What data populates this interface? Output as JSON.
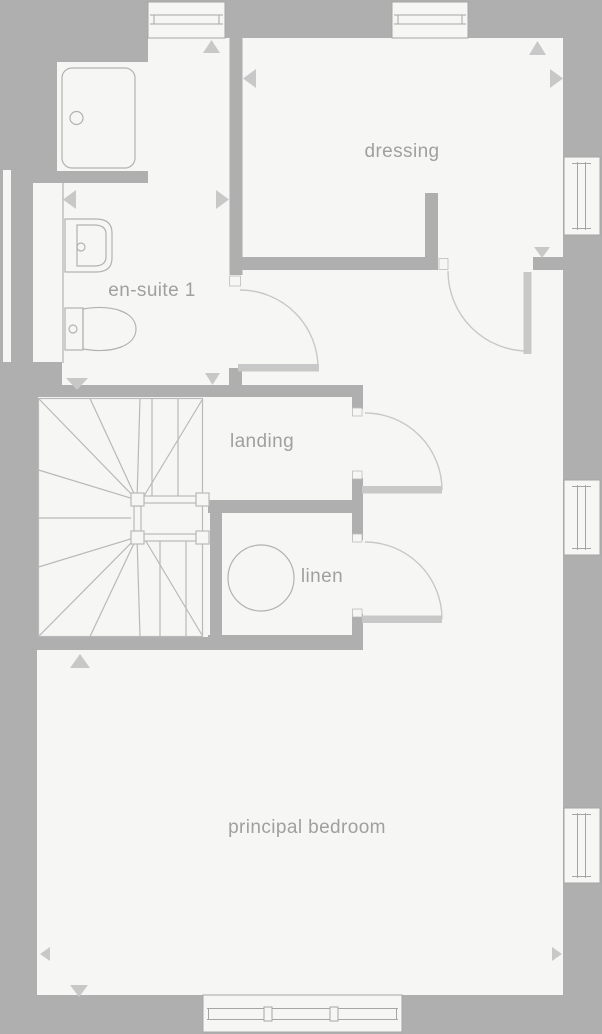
{
  "plan": {
    "type": "floor-plan",
    "rooms": [
      {
        "name": "dressing"
      },
      {
        "name": "en-suite 1"
      },
      {
        "name": "landing"
      },
      {
        "name": "linen"
      },
      {
        "name": "principal bedroom"
      }
    ],
    "fixtures": [
      "shower-tray",
      "basin",
      "toilet",
      "winder-staircase",
      "linen-tank"
    ],
    "doors": [
      "dressing-door",
      "en-suite-door",
      "landing-door",
      "linen-door"
    ],
    "windows": [
      "top-left-window",
      "top-right-window",
      "right-upper-window",
      "right-middle-window",
      "right-lower-window",
      "bottom-window"
    ],
    "colors": {
      "wall_and_background": "#b0afaf",
      "floor": "#f6f6f4",
      "fixture_line": "#b2b2b2",
      "window_line": "#a6a6a6",
      "door_and_arrow": "#c9c8c8",
      "label_text": "#a0a0a0"
    }
  }
}
